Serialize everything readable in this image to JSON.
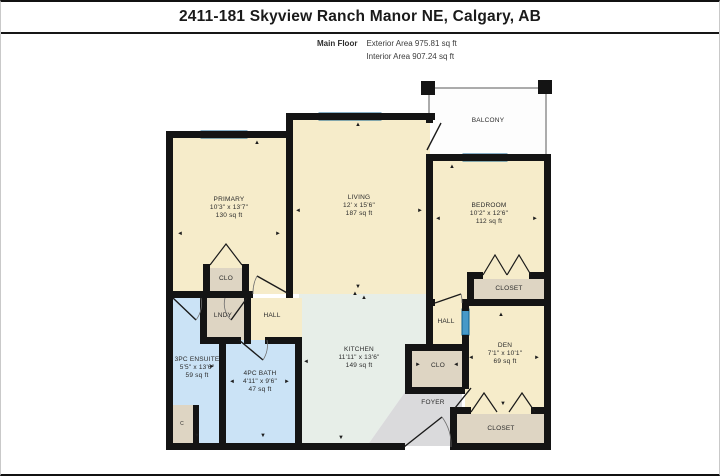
{
  "page": {
    "title": "2411-181 Skyview Ranch Manor NE, Calgary, AB"
  },
  "subheader": {
    "floor": "Main Floor",
    "exterior": "Exterior Area 975.81 sq ft",
    "interior": "Interior Area 907.24 sq ft"
  },
  "rooms": [
    {
      "name": "PRIMARY",
      "dims": "10'3\" x 13'7\"",
      "area": "130 sq ft"
    },
    {
      "name": "LIVING",
      "dims": "12' x 15'6\"",
      "area": "187 sq ft"
    },
    {
      "name": "BEDROOM",
      "dims": "10'2\" x 12'6\"",
      "area": "112 sq ft"
    },
    {
      "name": "KITCHEN",
      "dims": "11'11\" x 13'6\"",
      "area": "149 sq ft"
    },
    {
      "name": "3PC ENSUITE",
      "dims": "5'5\" x 13'6\"",
      "area": "59 sq ft"
    },
    {
      "name": "4PC BATH",
      "dims": "4'11\" x 9'6\"",
      "area": "47 sq ft"
    },
    {
      "name": "DEN",
      "dims": "7'1\" x 10'1\"",
      "area": "69 sq ft"
    }
  ],
  "labels": {
    "balcony": "BALCONY",
    "closet": "CLOSET",
    "clo": "CLO",
    "lndy": "LNDY",
    "hall": "HALL",
    "foyer": "FOYER",
    "small_closet": "C"
  },
  "icons": {
    "arrow_up": "▲",
    "arrow_down": "▼",
    "arrow_left": "◄",
    "arrow_right": "►"
  },
  "colors": {
    "wall": "#141414",
    "room": "#f6ecca",
    "kitchen": "#e7eee8",
    "bath": "#cbe3f6",
    "closet": "#ded5c3",
    "foyer": "#dadadc",
    "window": "#4699c8",
    "window_border": "#0f5f8e",
    "balcony": "#fdfdfd",
    "line": "#1a1a1a"
  }
}
